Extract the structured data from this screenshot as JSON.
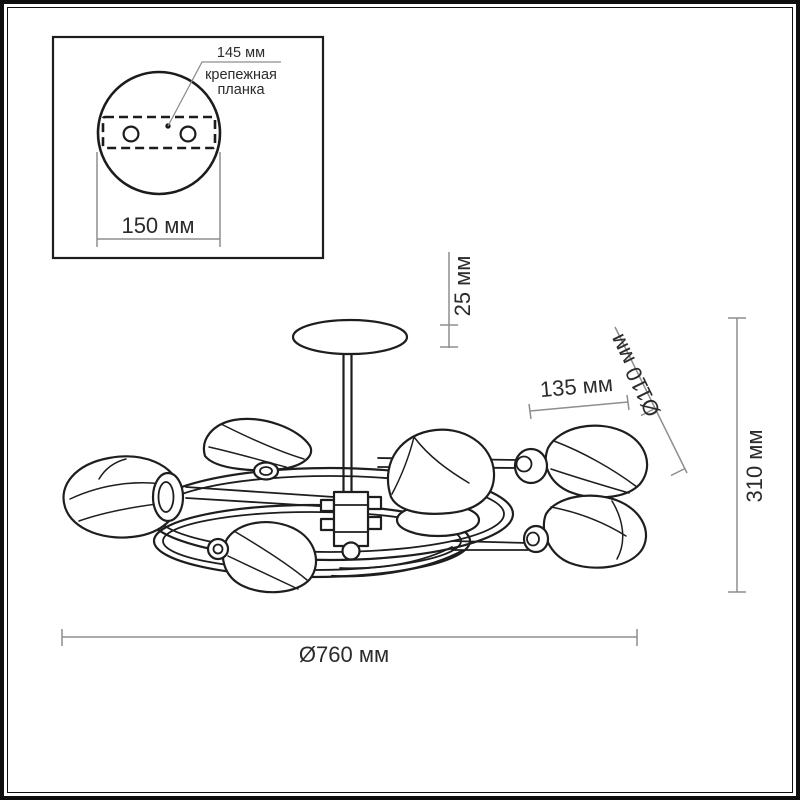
{
  "inset": {
    "dim_145": "145 мм",
    "label_line1": "крепежная",
    "label_line2": "планка",
    "dim_150": "150 мм"
  },
  "main": {
    "dim_25": "25 мм",
    "dim_135": "135 мм",
    "dim_110": "Ø110 мм",
    "dim_310": "310 мм",
    "dim_760": "Ø760 мм"
  },
  "colors": {
    "outline": "#1e1e1e",
    "dim_line": "#8e8e8e",
    "label_text": "#2b2b2b",
    "background": "#ffffff"
  }
}
